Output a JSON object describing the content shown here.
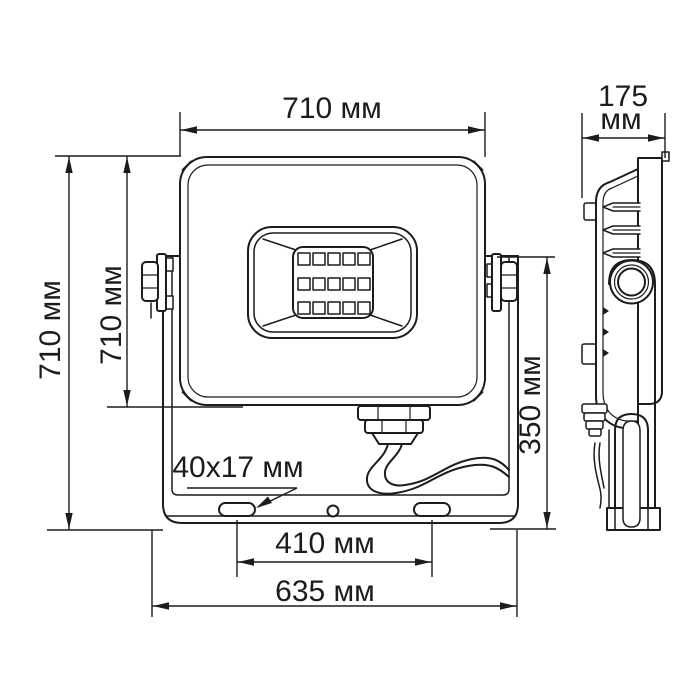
{
  "drawing": {
    "product": "LED floodlight dimensional drawing",
    "units": "мм",
    "line_color": "#1c1c1c",
    "background": "#ffffff"
  },
  "front": {
    "width_top": "710 мм",
    "height_overall": "710 мм",
    "height_body": "710 мм",
    "bracket_height": "350 мм",
    "mount_slot_size": "40x17 мм",
    "slot_spacing": "410 мм",
    "bracket_width": "635 мм"
  },
  "side": {
    "depth_value": "175",
    "depth_unit": "мм"
  }
}
